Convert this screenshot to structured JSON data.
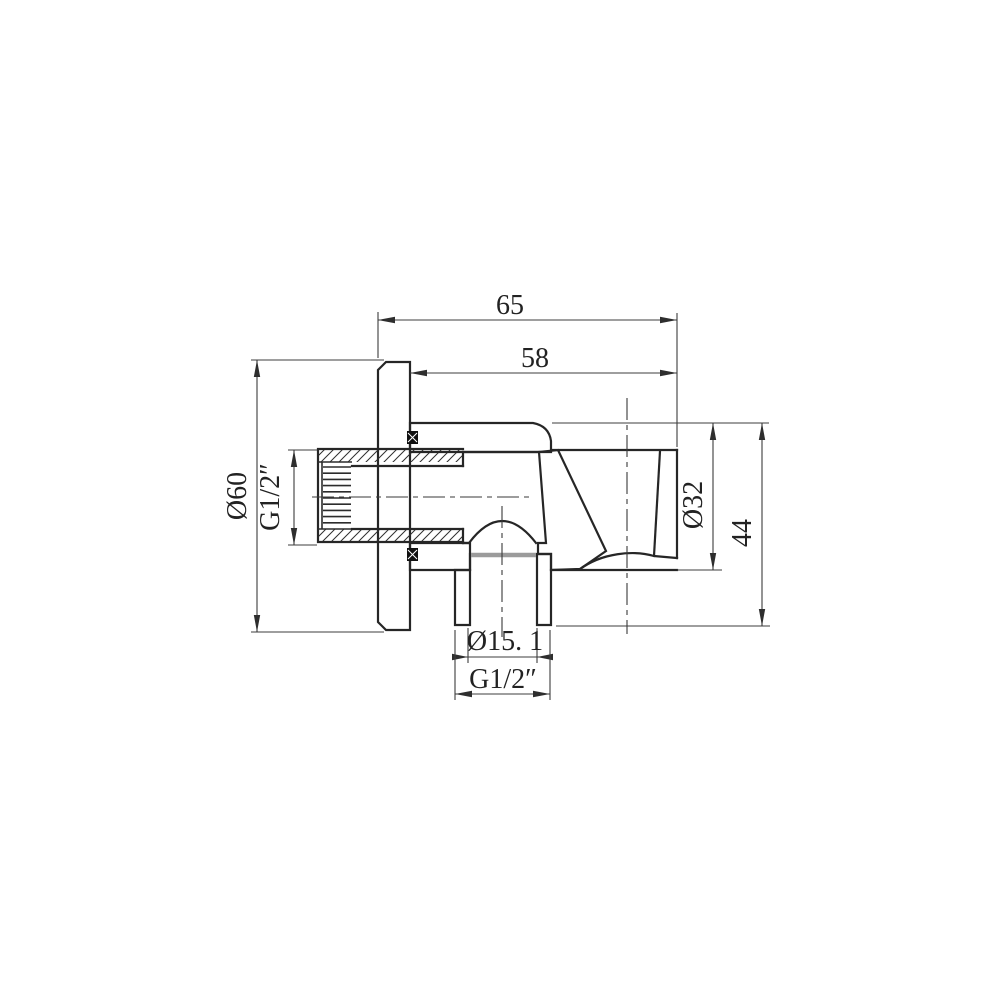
{
  "page": {
    "background": "#ffffff",
    "title": "Shower wall outlet elbow with handset holder - section drawing"
  },
  "drawing": {
    "type": "technical-section",
    "line_color": "#262626",
    "dimension_color": "#3c3c3c",
    "hatch_color": "#2f2f2f",
    "labels": {
      "width_overall": "65",
      "width_projection": "58",
      "flange_diameter": "Ø60",
      "inlet_thread": "G1/2″",
      "holder_diameter": "Ø32",
      "holder_height": "44",
      "outlet_bore": "Ø15. 1",
      "outlet_thread": "G1/2″"
    }
  }
}
